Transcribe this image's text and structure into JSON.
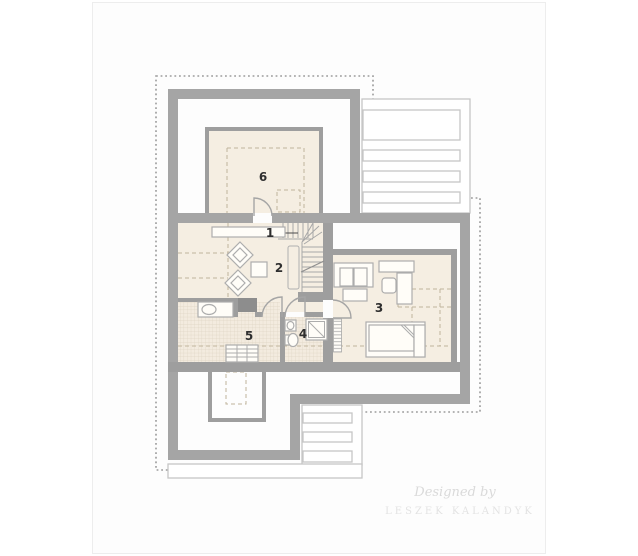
{
  "title": "attic floor plan",
  "rooms": {
    "r1": "1",
    "r2": "2",
    "r3": "3",
    "r4": "4",
    "r5": "5",
    "r6": "6"
  },
  "watermark": {
    "line1": "Designed by",
    "line2": "LESZEK KALANDYK"
  },
  "colors": {
    "wall": "#a5a5a5",
    "wall_thin": "#9e9e9e",
    "chimney": "#8d8d8d",
    "floor": "#f5eee2",
    "tile_grid": "#ddd3c2",
    "interior_dash": "#c0b49c",
    "roof_dash": "#9b9b9b",
    "deck_outline": "#c6c6c6",
    "label_text": "#2f2f2f",
    "watermark_text": "#dadada"
  }
}
